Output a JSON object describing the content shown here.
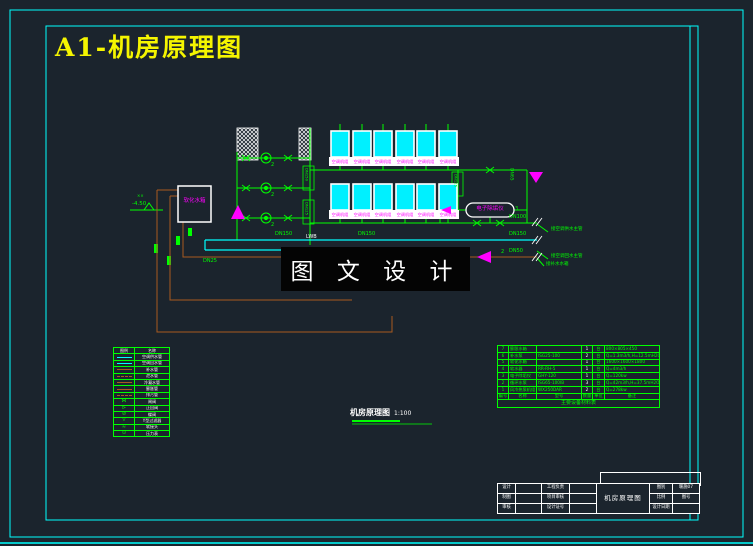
{
  "drawing": {
    "sheet_title": "A1-机房原理图",
    "caption": "机房原理图",
    "caption_scale": "1:100",
    "watermark": "图 文 设 计"
  },
  "schematic": {
    "unit_tag": "空调机组",
    "softener_tank_label": "软化水箱",
    "descaler_label": "电子除垢仪",
    "riser_tag_left_top": "DN150",
    "riser_tag_left_bottom": "DN125",
    "riser_tag_right": "DN125",
    "elevation_label": "-4.50",
    "pump_no": "2",
    "valve_no": "3",
    "line_tag": "LWB",
    "marks": "××",
    "dn150": "DN150",
    "dn100": "DN100",
    "dn65": "DN65",
    "dn50": "DN50",
    "dn25": "DN25",
    "leaders": [
      {
        "text": "接空调供水主管"
      },
      {
        "text": "接空调回水主管"
      },
      {
        "text": "接补水水箱"
      }
    ]
  },
  "legend": {
    "headers": [
      "图例",
      "名称"
    ],
    "rows": [
      {
        "symbol": "cyan-line",
        "name": "空调供水管"
      },
      {
        "symbol": "cyan-line",
        "name": "空调回水管"
      },
      {
        "symbol": "brown-line",
        "name": "补水管"
      },
      {
        "symbol": "brown-dash",
        "name": "泄水管"
      },
      {
        "symbol": "brown-line",
        "name": "冷凝水管"
      },
      {
        "symbol": "brown-line",
        "name": "膨胀管"
      },
      {
        "symbol": "brown-dash",
        "name": "排污管"
      },
      {
        "symbol": "gate-valve",
        "name": "闸阀"
      },
      {
        "symbol": "check-valve",
        "name": "止回阀"
      },
      {
        "symbol": "butterfly-valve",
        "name": "蝶阀"
      },
      {
        "symbol": "strainer",
        "name": "Y型过滤器"
      },
      {
        "symbol": "flex-joint",
        "name": "软接头"
      },
      {
        "symbol": "gauge",
        "name": "压力表"
      }
    ]
  },
  "equipment_table": {
    "caption": "主要设备材料表",
    "headers": [
      "编号",
      "名称",
      "型号",
      "数量",
      "单位",
      "备注"
    ],
    "rows": [
      [
        "7",
        "膨胀水箱",
        "",
        "1",
        "台",
        "800×805×450"
      ],
      [
        "6",
        "补水泵",
        "ISG25-100",
        "2",
        "台",
        "Q=1.3m3/h,H=12.5mH2O"
      ],
      [
        "5",
        "软化水箱",
        "",
        "1",
        "台",
        "1600×1600×1800"
      ],
      [
        "4",
        "软水器",
        "RR-RH-5",
        "1",
        "台",
        "Q=4m3/h"
      ],
      [
        "3",
        "电子除垢仪",
        "GHY-120",
        "1",
        "台",
        "Q=120kw"
      ],
      [
        "2",
        "循环水泵",
        "ISG65-100IB",
        "3",
        "台",
        "Q=42m3/h,H=37.5mH2O"
      ],
      [
        "1",
        "风冷热泵机组",
        "WX250DAR",
        "2",
        "台",
        "Q=278kw"
      ]
    ]
  },
  "title_block": {
    "center_title": "机房原理图",
    "rows": [
      {
        "a": "设计",
        "b": "",
        "c": "工程负责",
        "d": "",
        "e": "图别",
        "f": "暖施07"
      },
      {
        "a": "制图",
        "b": "",
        "c": "项目审核",
        "d": "",
        "e": "比例",
        "f": "图号"
      },
      {
        "a": "审核",
        "b": "",
        "c": "设计证号",
        "d": "",
        "e": "设计日期",
        "f": ""
      }
    ]
  }
}
